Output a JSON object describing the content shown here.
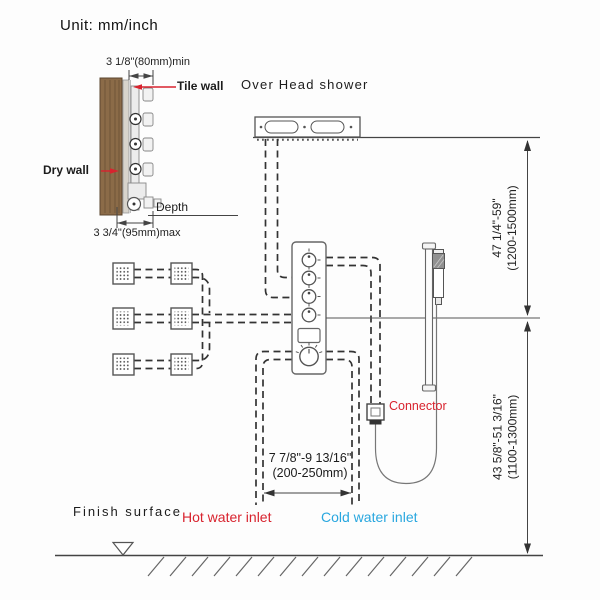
{
  "unit_label": "Unit: mm/inch",
  "wall_detail": {
    "dim_min": "3 1/8\"(80mm)min",
    "dim_max": "3 3/4\"(95mm)max",
    "tile_wall": "Tile wall",
    "dry_wall": "Dry wall",
    "depth": "Depth"
  },
  "overhead_label": "Over Head shower",
  "dimensions": {
    "right_upper": {
      "inch": "47 1/4\"-59\"",
      "mm": "(1200-1500mm)"
    },
    "right_lower": {
      "inch": "43 5/8\"-51 3/16\"",
      "mm": "(1100-1300mm)"
    },
    "inlet_spacing": {
      "inch": "7 7/8\"-9 13/16\"",
      "mm": "(200-250mm)"
    }
  },
  "labels": {
    "connector": "Connector",
    "hot_inlet": "Hot water inlet",
    "cold_inlet": "Cold water inlet",
    "finish_surface": "Finish surface"
  },
  "colors": {
    "red": "#d8232e",
    "blue": "#29a7df",
    "line": "#3b3b3b",
    "wood": "#8b6b48"
  }
}
